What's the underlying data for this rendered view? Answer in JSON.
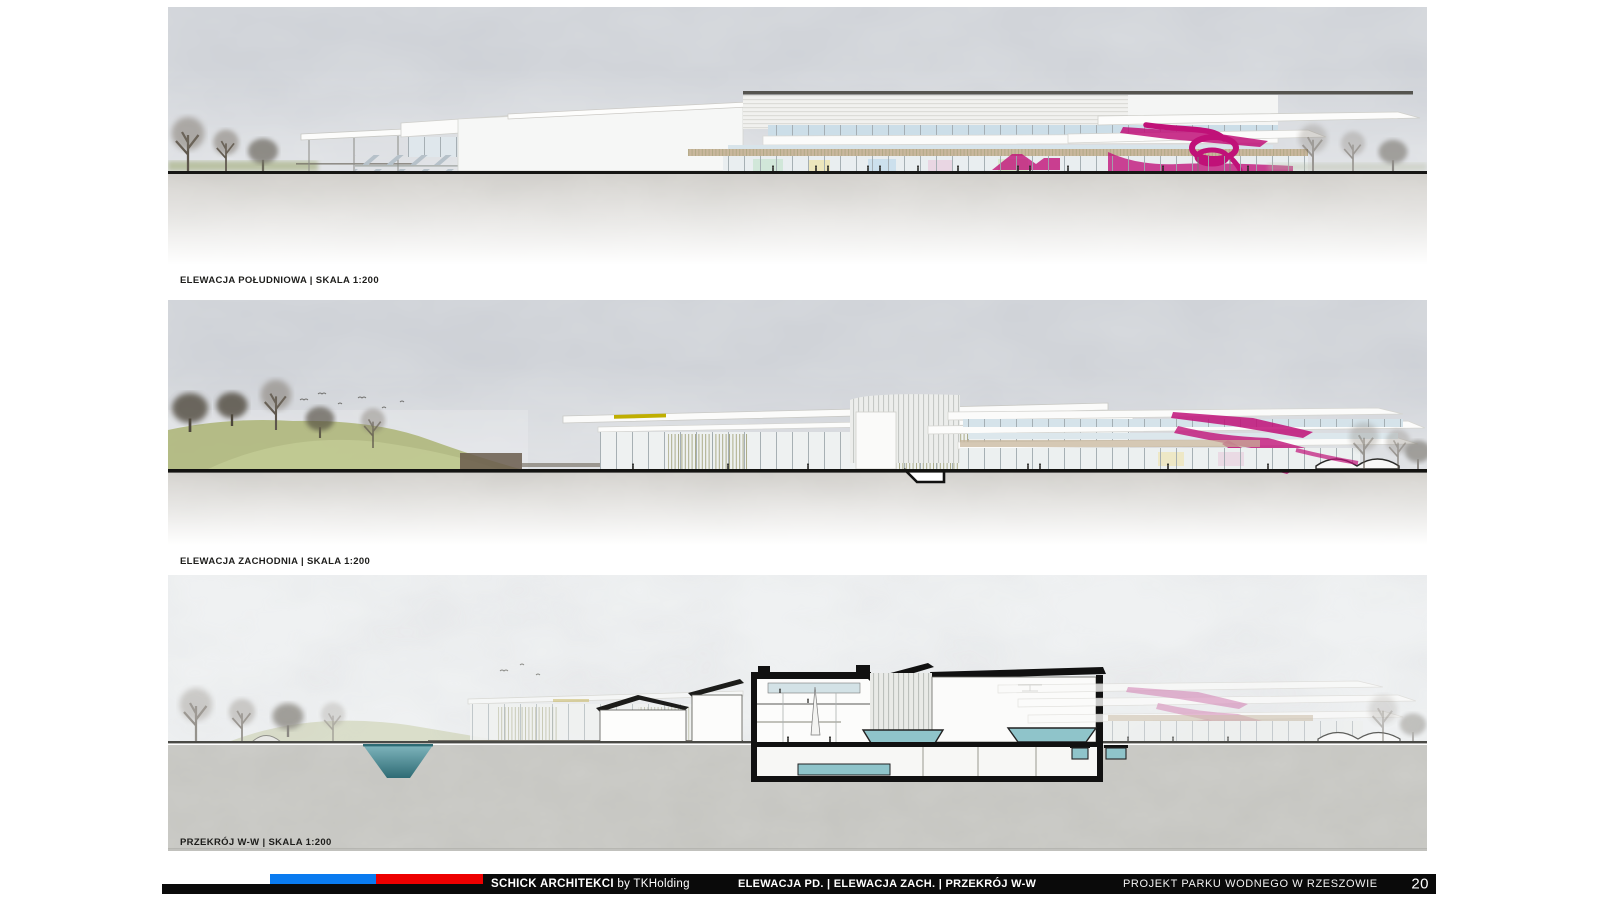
{
  "page": {
    "number": "20"
  },
  "panels": [
    {
      "id": "south-elevation",
      "label": "ELEWACJA POŁUDNIOWA | SKALA 1:200"
    },
    {
      "id": "west-elevation",
      "label": "ELEWACJA ZACHODNIA | SKALA 1:200"
    },
    {
      "id": "section-ww",
      "label": "PRZEKRÓJ W-W | SKALA 1:200"
    }
  ],
  "footer": {
    "studio_bold": "SCHICK ARCHITEKCI",
    "studio_suffix": " by TKHolding",
    "sheet_title": "ELEWACJA PD. | ELEWACJA ZACH. | PRZEKRÓJ W-W",
    "project_title": "PROJEKT PARKU WODNEGO W RZESZOWIE",
    "page_number": "20"
  },
  "colors": {
    "footer-blue": "#0a7bf0",
    "footer-red": "#ee0000",
    "ink": "#0a0a0a",
    "magenta": "#c01178",
    "magenta-soft": "#cf6ea8",
    "pool-teal": "#8fc4ca",
    "pond-deep": "#2e6b74",
    "hill-green": "#9aa557"
  }
}
